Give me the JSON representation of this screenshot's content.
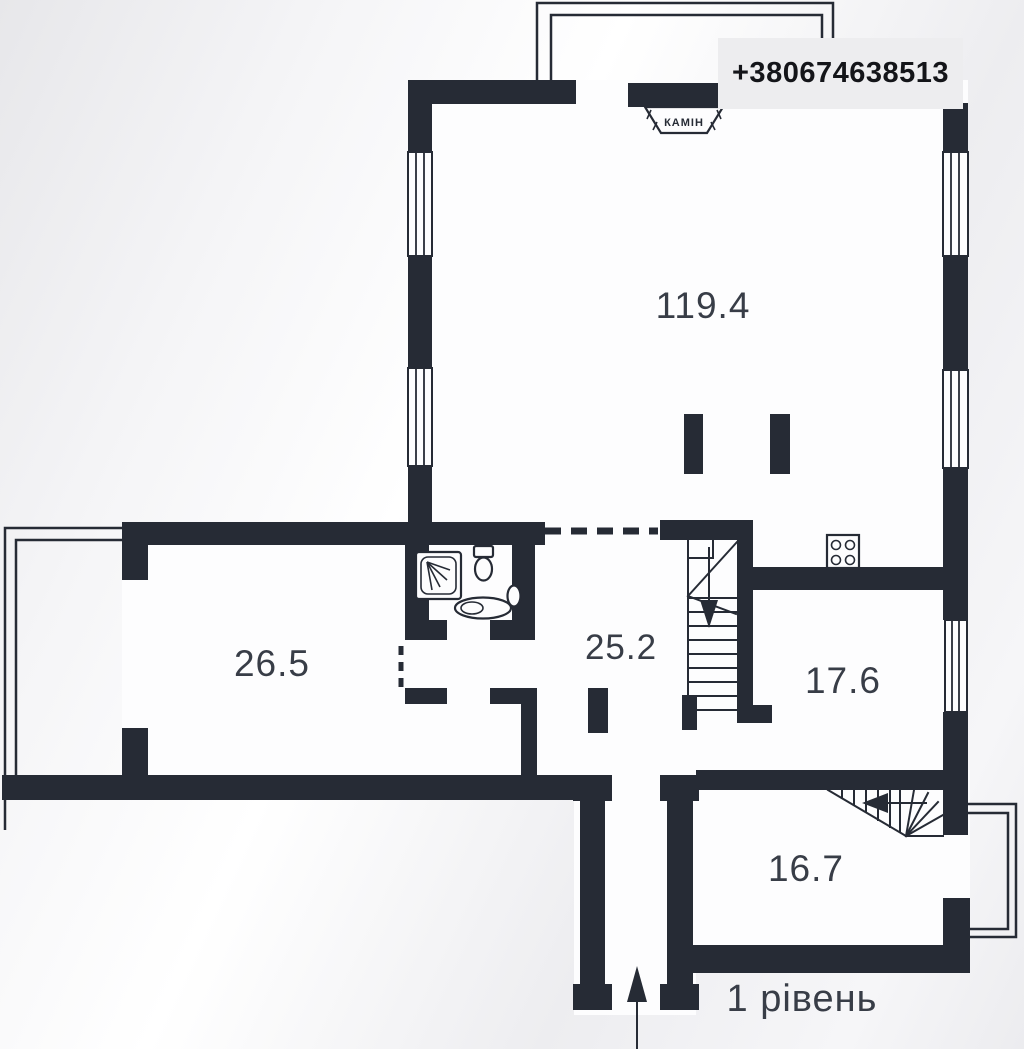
{
  "contact": {
    "phone": "+380674638513"
  },
  "plan": {
    "level_label": "1 рівень",
    "fireplace_label": "КАМІН",
    "wall_color": "#262b35",
    "label_color": "#383d47",
    "phone_box_bg": "#ededef",
    "rooms": [
      {
        "name": "living-room",
        "area": "119.4"
      },
      {
        "name": "left-room",
        "area": "26.5"
      },
      {
        "name": "hall",
        "area": "25.2"
      },
      {
        "name": "right-room",
        "area": "17.6"
      },
      {
        "name": "lower-room",
        "area": "16.7"
      }
    ],
    "icons": {
      "fireplace": "fireplace-icon",
      "stove": "stove-icon",
      "shower": "shower-icon",
      "toilet": "toilet-icon",
      "sink": "sink-icon",
      "washbasin": "washbasin-icon",
      "stairs_main": "staircase-down-icon",
      "stairs_winder": "winder-stairs-icon",
      "entrance": "entrance-arrow-icon",
      "window": "window-symbol"
    }
  }
}
